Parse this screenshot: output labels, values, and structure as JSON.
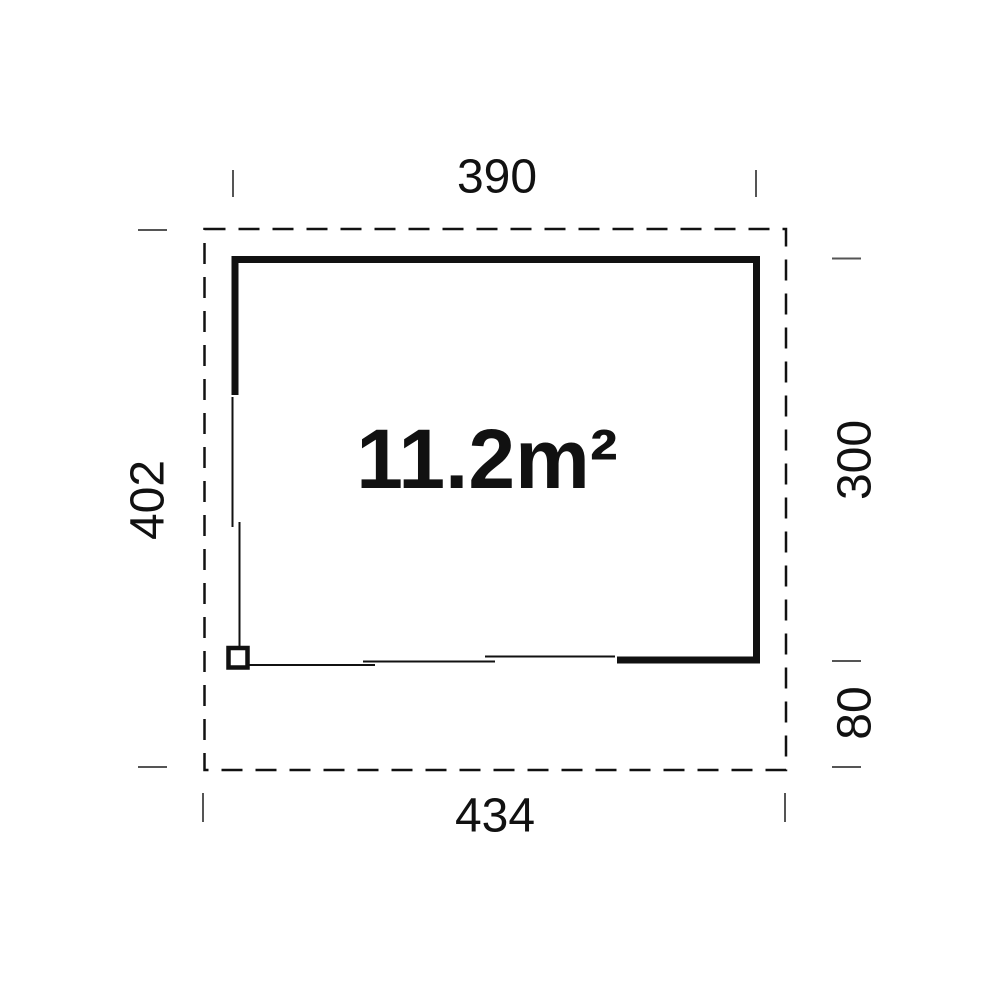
{
  "diagram": {
    "kind": "floor-plan",
    "area_label": "11.2m²",
    "dimensions": {
      "top_width": "390",
      "left_total_depth": "402",
      "right_inner_depth": "300",
      "right_front_extension": "80",
      "bottom_total_width": "434"
    },
    "colors": {
      "background": "#ffffff",
      "line": "#111111",
      "tick": "#555555",
      "text": "#111111"
    }
  }
}
